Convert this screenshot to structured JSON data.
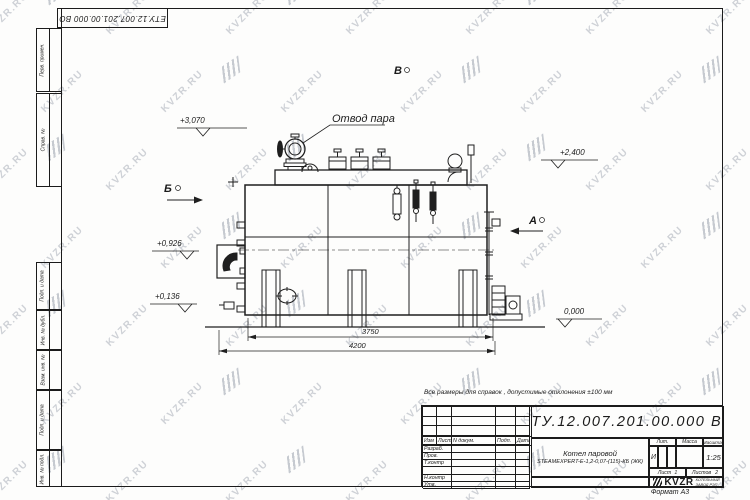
{
  "sheet": {
    "doc_number": "ЕТУ.12.007.201.00.000  ВО",
    "format_label": "Формат А3",
    "note": "Все размеры для справок , допустимые отклонения  ±100 мм"
  },
  "watermark": {
    "text": "KVZR.RU"
  },
  "margin": {
    "perv_primen": "Перв. примен.",
    "sprav_no": "Справ. №",
    "podp_data_1": "Подп. и дата",
    "inv_dubl": "Инв. № дубл.",
    "vzam_inv": "Взам. инв. №",
    "podp_data_2": "Подп. и дата",
    "inv_podl": "Инв. № подл."
  },
  "drawing": {
    "steam_outlet_label": "Отвод пара",
    "view_a": "А",
    "view_b": "Б",
    "view_v": "В",
    "elev_top": "+3,070",
    "elev_right": "+2,400",
    "elev_mid": "+0,926",
    "elev_low": "+0,136",
    "elev_zero": "0,000",
    "dim_inner": "3750",
    "dim_outer": "4200"
  },
  "title_block": {
    "header": {
      "izm": "Изм",
      "list": "Лист",
      "n_dokum": "N докум.",
      "podp": "Подп.",
      "data": "Дата"
    },
    "rows": {
      "r1": "Разраб.",
      "r2": "Пров.",
      "r3": "Т.контр",
      "r4": "",
      "r5": "Н.контр",
      "r6": "Утв."
    },
    "product_line1": "Котел паровой",
    "product_line2": "STEAMEXPERT-Е-1,2-0,07-(115)-КБ (ЖК)",
    "lit_label": "Лит.",
    "lit_value": "И",
    "mass_label": "Масса",
    "scale_label": "Масштаб",
    "scale_value": "1:25",
    "sheet_label": "Лист",
    "sheet_value": "1",
    "sheets_label": "Листов",
    "sheets_value": "2",
    "logo_text": "KVZR",
    "logo_line1": "КОТЕЛЬНЫЙ",
    "logo_line2": "ЗАВОД РЭП"
  }
}
